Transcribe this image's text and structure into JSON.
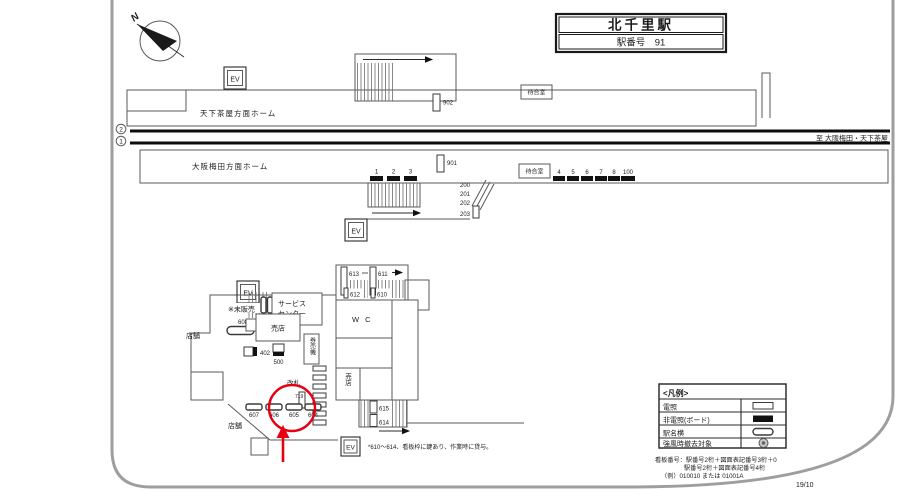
{
  "title": {
    "station": "北千里駅",
    "number": "駅番号　91"
  },
  "compass": {
    "n": "N"
  },
  "upper": {
    "platform": "天下茶屋方面ホーム",
    "ev": "EV",
    "b902": "902",
    "waiting": "待合室"
  },
  "tracks": {
    "n2": "2",
    "n1": "1",
    "dest": "至 大阪梅田・天下茶屋"
  },
  "lower": {
    "platform": "大阪梅田方面ホーム",
    "waiting": "待合室",
    "ev": "EV",
    "b1": "1",
    "b2": "2",
    "b3": "3",
    "b901": "901",
    "b200": "200",
    "b201": "201",
    "b202": "202",
    "b203": "203",
    "b4": "4",
    "b5": "5",
    "b6": "6",
    "b7": "7",
    "b8": "8",
    "b100": "100"
  },
  "concourse": {
    "ev_top": "EV",
    "ev_bottom": "EV",
    "b613": "613",
    "b611": "611",
    "b612": "612",
    "b610": "610",
    "service1": "サービス",
    "service2": "センター",
    "unsold": "※未販売",
    "b608": "608",
    "kiosk": "売店",
    "kiosk_v": "売店",
    "store_upper": "店舗",
    "store_lower": "店舗",
    "b402": "402",
    "b500": "500",
    "ticket_machine": "券売機",
    "wc": "W C",
    "gate": "改札",
    "small_note": "719",
    "b607": "607",
    "b606": "606",
    "b605": "605",
    "b604": "604",
    "b615": "615",
    "b614": "614",
    "lock_note": "*610～614、看板枠に鍵あり、作業時に貸与。"
  },
  "legend": {
    "title": "<凡例>",
    "row1": "電照",
    "row2": "非電照(ボード)",
    "row3": "駅名横",
    "row4": "強風時撤去対象"
  },
  "footer": {
    "line1": "看板番号：駅番号2桁＋図面表記番号3桁＋0",
    "line2": "駅番号2桁＋図面表記番号4桁",
    "line3": "（例）010010 または 01001A",
    "code": "19/10"
  }
}
